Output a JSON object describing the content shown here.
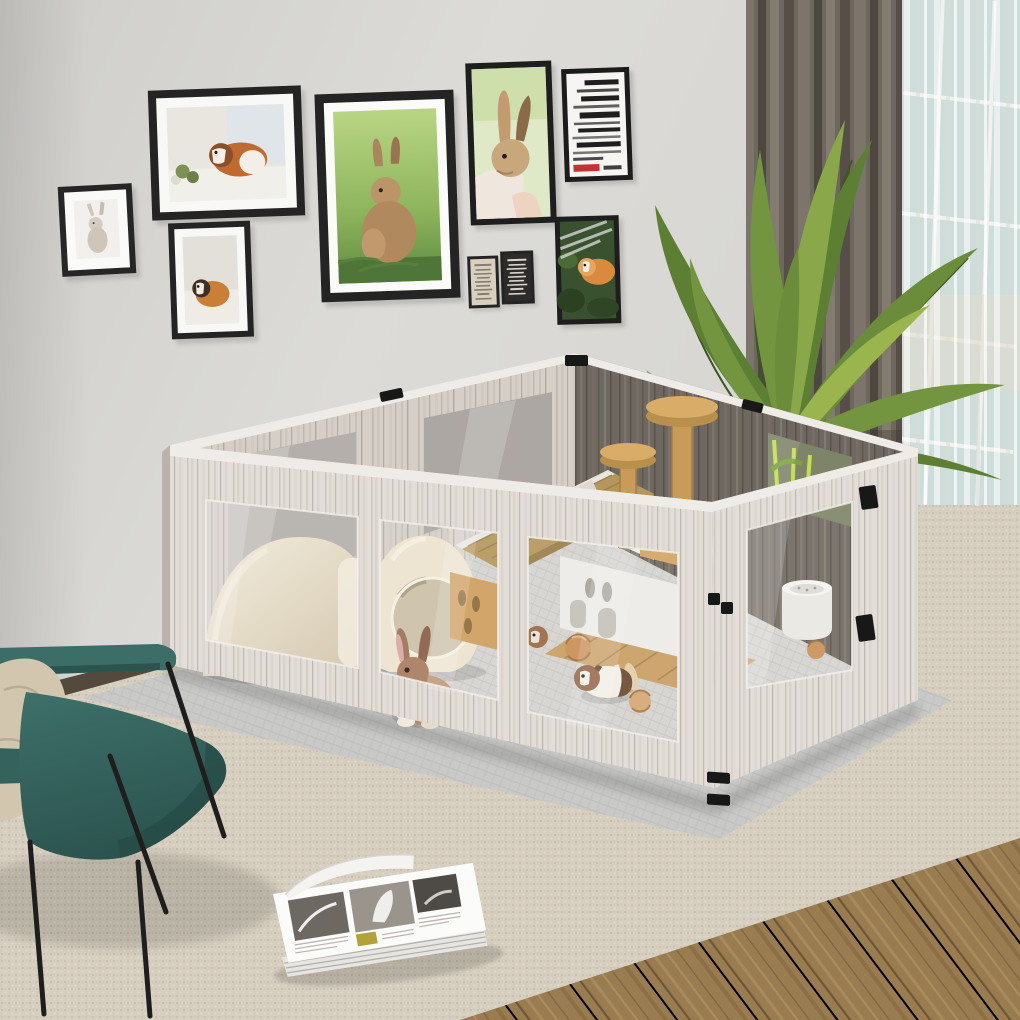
{
  "scene": {
    "description": "Lifestyle product photo: a large whitewashed-wood small-pet playpen with clear acrylic windows sits on a gray mat over a woven beige rug in a bright living room. Inside are a rabbit, guinea pigs, ceramic hideouts, a wooden pet house with hay roof, a climbing tower, a litter bowl and wicker balls. A gallery wall of rabbit and guinea-pig art hangs above; a palm plant, gray curtain and sheer window dress the right side; a teal armchair with a beige pillow sits front-left and an open magazine lies on the rug.",
    "room": {
      "wall": "plain light gray wall",
      "window": "daylight window behind sheer curtain",
      "floor": "wood plank floor with large woven area rug"
    },
    "wall_frames": [
      {
        "id": "frame-rabbit-small",
        "subject": "white rabbit illustration",
        "orientation": "portrait",
        "style": "black frame, white mat"
      },
      {
        "id": "frame-guineapig-windowsill",
        "subject": "guinea pig on windowsill photo",
        "orientation": "landscape",
        "style": "black frame, white mat"
      },
      {
        "id": "frame-guineapig-portrait",
        "subject": "tan guinea pig photo",
        "orientation": "portrait",
        "style": "black frame, white mat"
      },
      {
        "id": "frame-bunny-grass",
        "subject": "brown bunny sitting on grass photo",
        "orientation": "portrait",
        "style": "black frame, white mat"
      },
      {
        "id": "frame-rabbit-held",
        "subject": "rabbit with tall ears held in hand photo",
        "orientation": "portrait",
        "style": "black frame, full bleed"
      },
      {
        "id": "frame-typography-poster",
        "subject": "black typography poster with red accent (text mirrored, illegible)",
        "orientation": "portrait",
        "style": "black frame"
      },
      {
        "id": "frame-mini-poster-light",
        "subject": "small beige text poster (illegible)",
        "orientation": "portrait",
        "style": "black frame"
      },
      {
        "id": "frame-mini-poster-dark",
        "subject": "small black text poster (illegible)",
        "orientation": "portrait",
        "style": "black frame"
      },
      {
        "id": "frame-guineapig-foliage",
        "subject": "guinea pig among dark foliage photo",
        "orientation": "portrait",
        "style": "black frame"
      }
    ],
    "playpen": {
      "material": "whitewashed wood-grain panels",
      "windows": "clear acrylic panes, three on front-left wall, one on front-right wall, two on interior back wall, one on dark back-right wall",
      "hardware": "black metal hinges, latches and top clips",
      "contents": [
        "ceramic dome hideout",
        "ceramic jug hideout with round opening",
        "wooden pet house with hay-mat roof",
        "wooden climbing tower with two round platforms",
        "white round litter bowl",
        "wicker chew balls",
        "birch chew log",
        "wood deck floor section",
        "gray grid floor mat"
      ]
    },
    "animals": [
      {
        "id": "rabbit",
        "description": "brown and white rabbit behind front acrylic window"
      },
      {
        "id": "guinea-pig-main",
        "description": "white guinea pig with brown and black patches"
      },
      {
        "id": "guinea-pig-peeking",
        "description": "brown guinea pig head peeking past window frame"
      }
    ],
    "furniture": {
      "armchair": "teal lounge chair with thin black metal legs",
      "pillow": "beige throw pillow",
      "magazine": "open magazine with grayscale photo spreads lying on rug"
    },
    "decor": {
      "plant": "areca palm in corner behind pen",
      "curtain_dark": "floor-length taupe curtain",
      "curtain_sheer": "white sheer over window"
    }
  },
  "palette": {
    "wall": "#d9d8d4",
    "rug": "#d6cfc0",
    "wood_floor": "#9a7c51",
    "mat": "#c9c9c7",
    "curtain_dark": "#6e675e",
    "window_glass": "#a9c4bd",
    "plant_green": "#5d7f33",
    "pen_wood": "#e2ded7",
    "pen_dark_wood": "#6f6860",
    "hardware": "#181818",
    "chair": "#34605b",
    "pillow": "#d2c6ae",
    "ceramic": "#ece3cf",
    "house_roof": "#b5975c",
    "wood_accent": "#cda05f"
  }
}
